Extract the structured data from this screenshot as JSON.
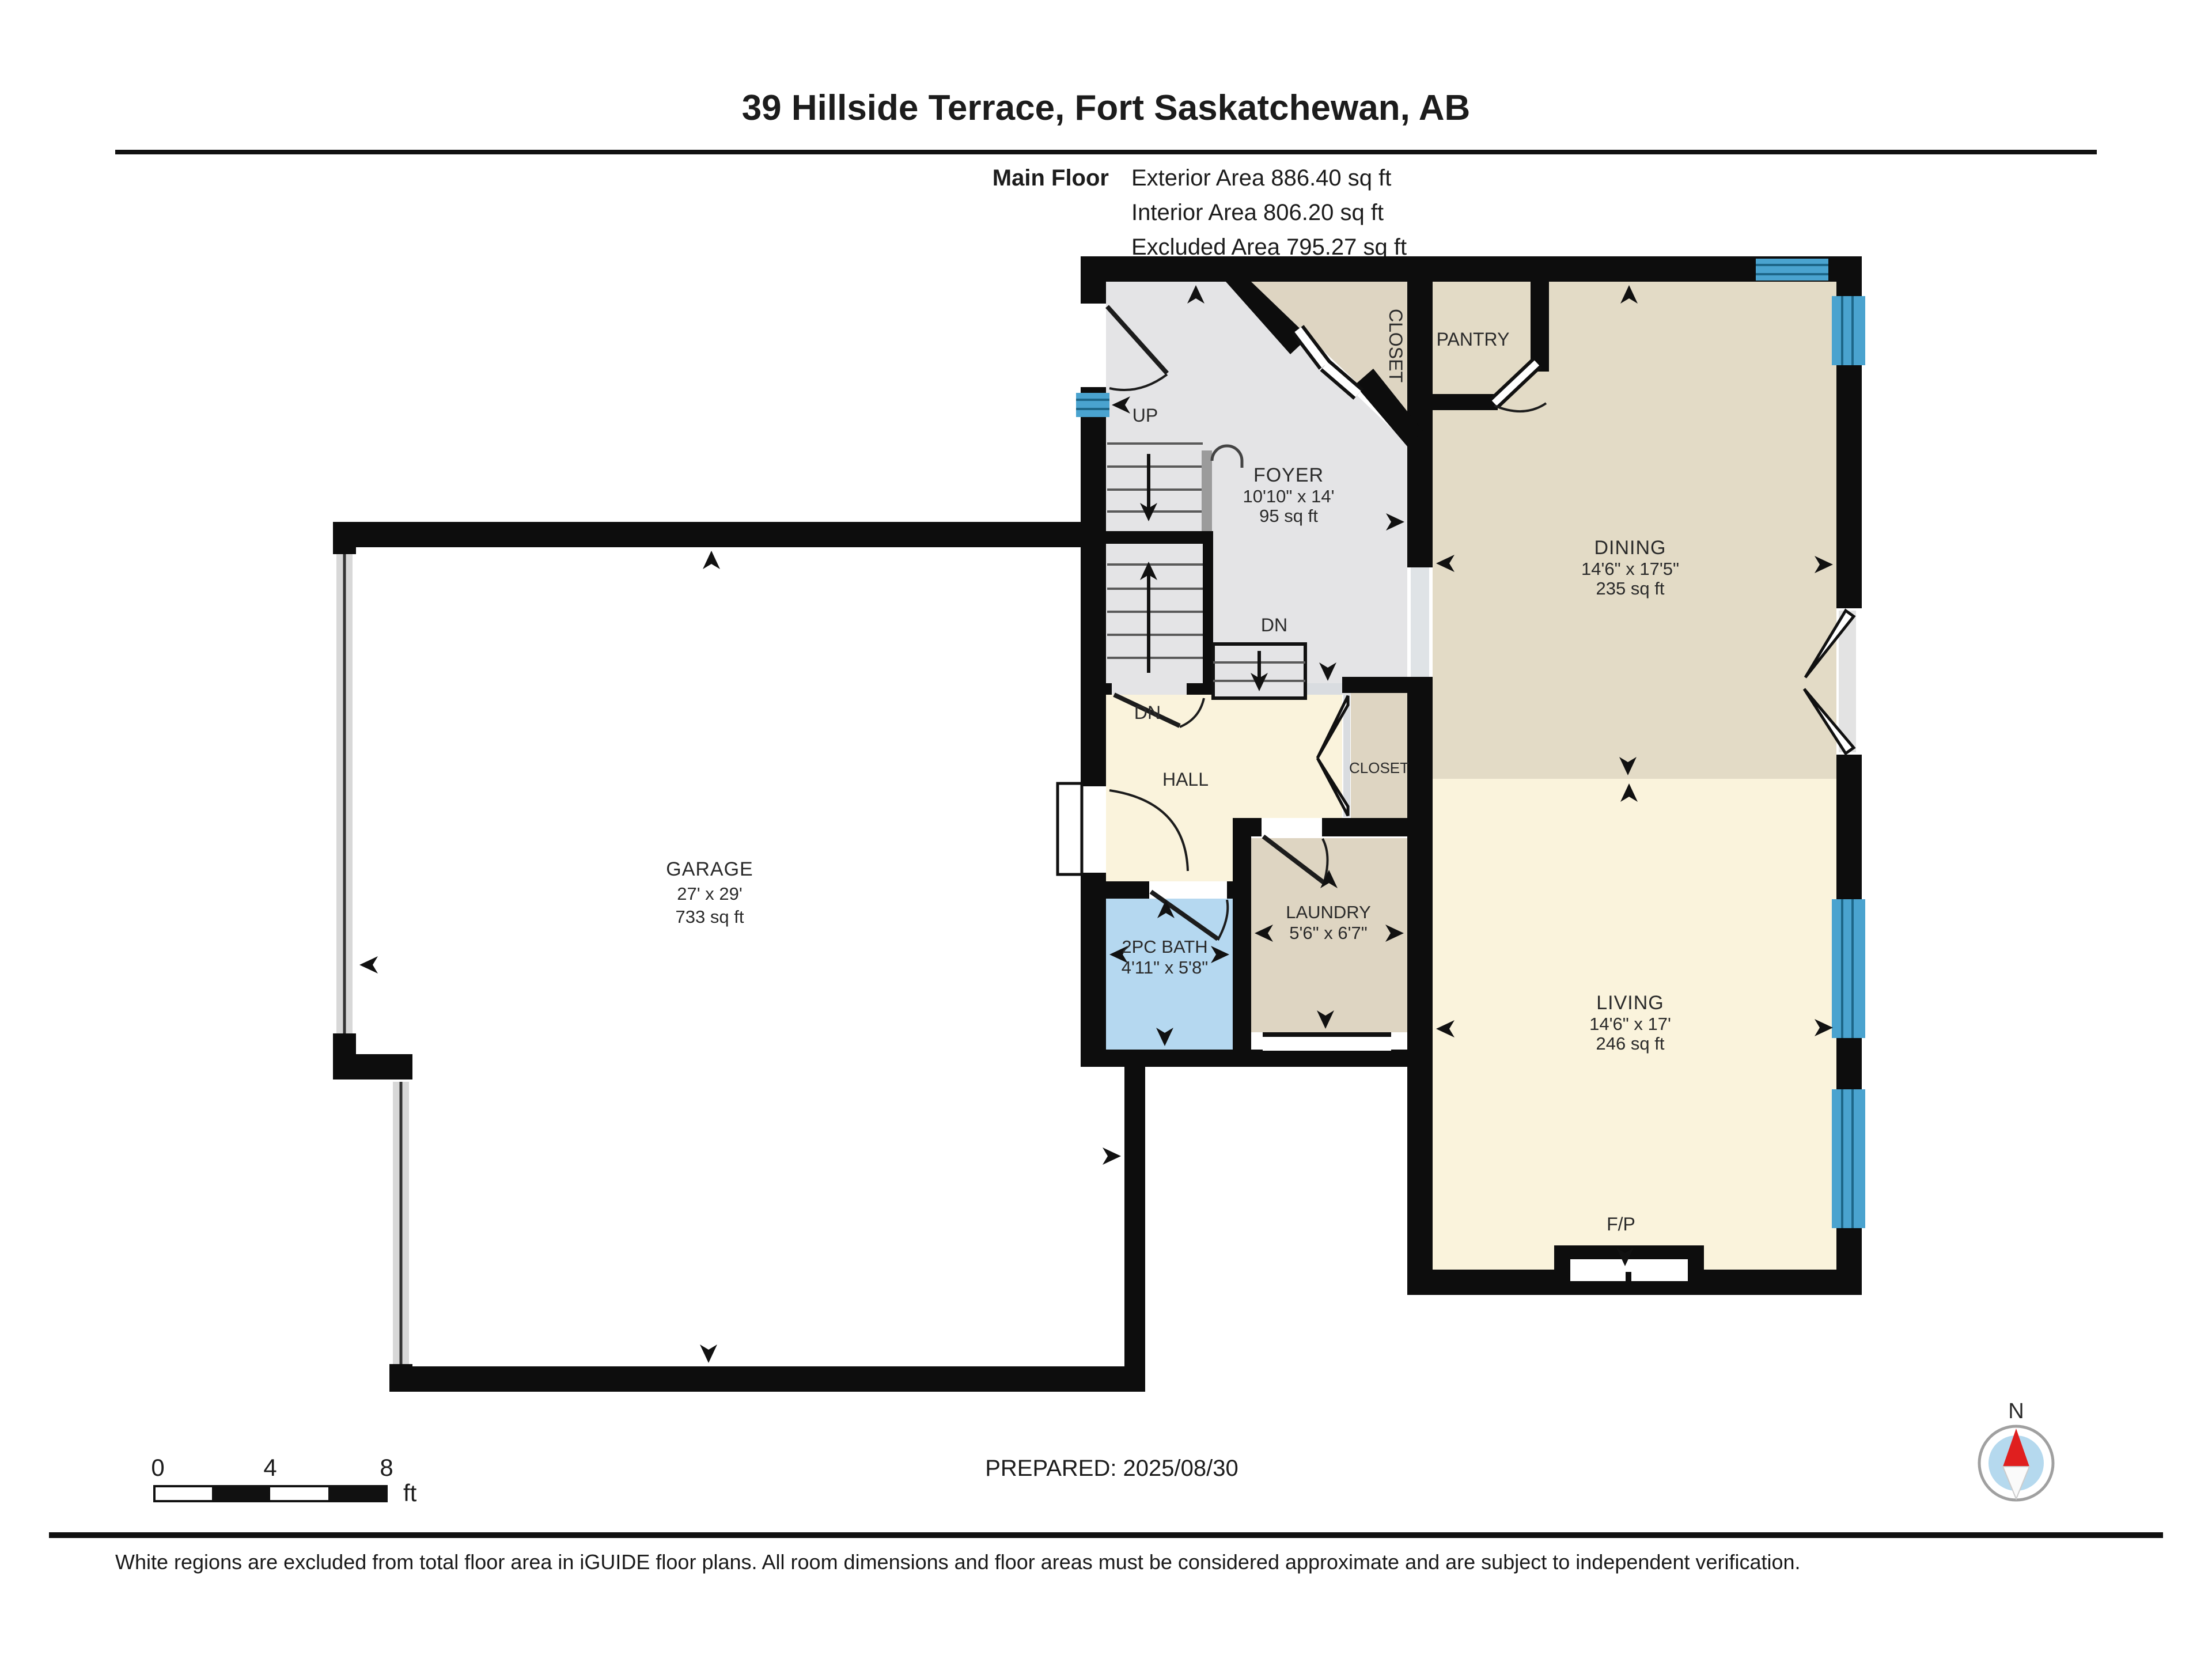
{
  "header": {
    "title": "39 Hillside Terrace, Fort Saskatchewan, AB",
    "floor_label": "Main Floor",
    "area_lines": [
      "Exterior Area 886.40 sq ft",
      "Interior Area 806.20 sq ft",
      "Excluded Area 795.27 sq ft"
    ]
  },
  "rooms": {
    "garage": {
      "name": "GARAGE",
      "dims": "27' x 29'",
      "area": "733 sq ft"
    },
    "foyer": {
      "name": "FOYER",
      "dims": "10'10\" x 14'",
      "area": "95 sq ft"
    },
    "dining": {
      "name": "DINING",
      "dims": "14'6\" x 17'5\"",
      "area": "235 sq ft"
    },
    "living": {
      "name": "LIVING",
      "dims": "14'6\" x 17'",
      "area": "246 sq ft"
    },
    "bath": {
      "name": "2PC BATH",
      "dims": "4'11\" x 5'8\""
    },
    "laundry": {
      "name": "LAUNDRY",
      "dims": "5'6\" x 6'7\""
    },
    "pantry": {
      "name": "PANTRY"
    },
    "hall": {
      "name": "HALL"
    },
    "closet_foyer": {
      "name": "CLOSET"
    },
    "closet_hall": {
      "name": "CLOSET"
    },
    "fireplace": {
      "name": "F/P"
    }
  },
  "stairs": {
    "up": "UP",
    "dn_foyer": "DN",
    "dn_hall": "DN"
  },
  "scale_bar": {
    "ticks": [
      "0",
      "4",
      "8"
    ],
    "unit": "ft"
  },
  "compass": {
    "north": "N"
  },
  "footer": {
    "prepared": "PREPARED: 2025/08/30",
    "disclaimer": "White regions are excluded from total floor area in iGUIDE floor plans. All room dimensions and floor areas must be considered approximate and are subject to independent verification."
  },
  "colors": {
    "wall": "#0d0d0d",
    "excluded_gray": "#e4e4e6",
    "cream": "#faf3dc",
    "beige": "#e3dbc6",
    "taupe": "#ded5c2",
    "bath_blue": "#b5d8f0",
    "window_blue": "#4aa3cf",
    "garage_door_gray": "#d8d8d8",
    "needle_red": "#e01f1f",
    "compass_blue": "#b5d9ee"
  }
}
